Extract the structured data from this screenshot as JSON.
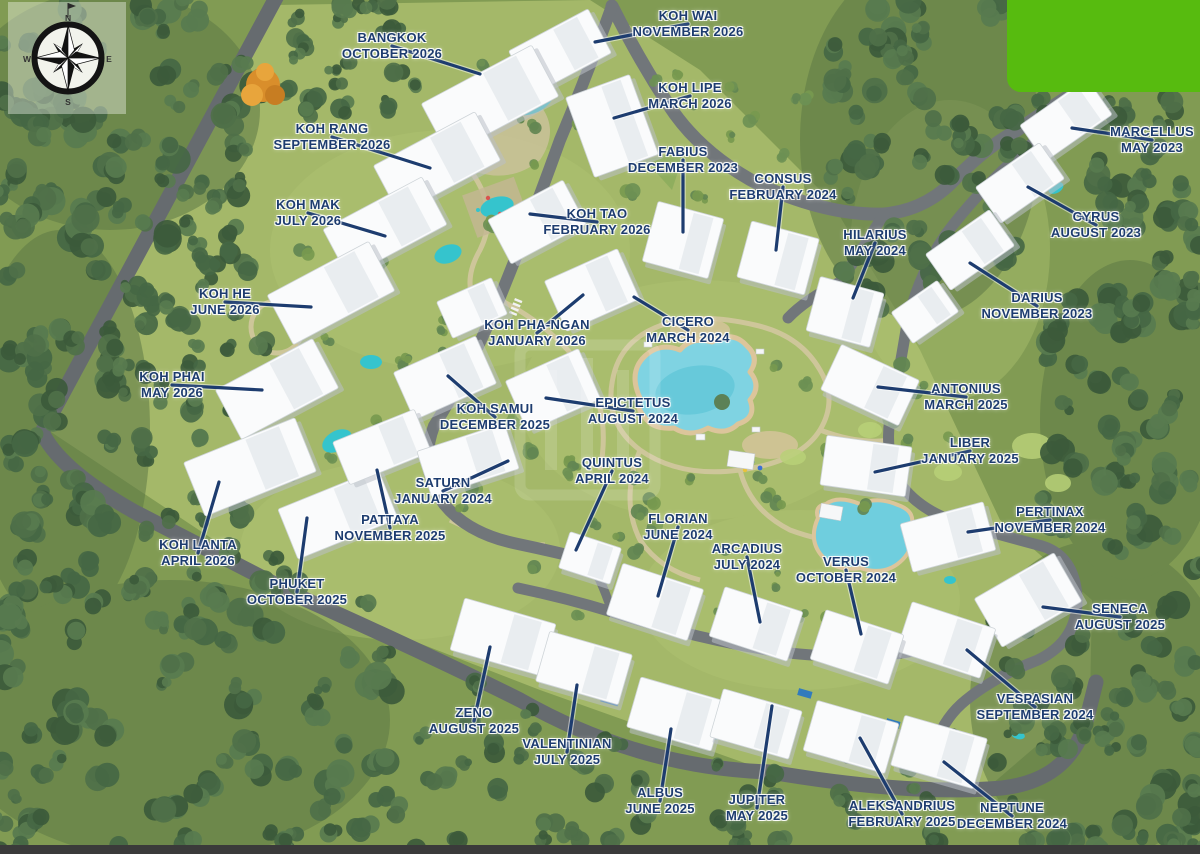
{
  "map": {
    "type": "resort-masterplan-aerial",
    "compass": {
      "north": "N",
      "east": "E",
      "south": "S",
      "west": "W"
    },
    "colors": {
      "label_text": "#1d3c6f",
      "leader_line": "#1d3c6f",
      "highlight_green": "#57bb0f",
      "bottom_bar": "#3a3a3a"
    },
    "buildings": [
      {
        "name": "BANGKOK",
        "date": "OCTOBER 2026",
        "lx": 392,
        "ly": 46,
        "ex": 480,
        "ey": 74
      },
      {
        "name": "KOH WAI",
        "date": "NOVEMBER 2026",
        "lx": 688,
        "ly": 24,
        "ex": 595,
        "ey": 42
      },
      {
        "name": "KOH LIPE",
        "date": "MARCH 2026",
        "lx": 690,
        "ly": 96,
        "ex": 614,
        "ey": 118
      },
      {
        "name": "KOH RANG",
        "date": "SEPTEMBER 2026",
        "lx": 332,
        "ly": 137,
        "ex": 430,
        "ey": 168
      },
      {
        "name": "FABIUS",
        "date": "DECEMBER 2023",
        "lx": 683,
        "ly": 160,
        "ex": 683,
        "ey": 232
      },
      {
        "name": "CONSUS",
        "date": "FEBRUARY 2024",
        "lx": 783,
        "ly": 187,
        "ex": 776,
        "ey": 250
      },
      {
        "name": "MARCELLUS",
        "date": "MAY 2023",
        "lx": 1152,
        "ly": 140,
        "ex": 1072,
        "ey": 128
      },
      {
        "name": "KOH MAK",
        "date": "JULY 2026",
        "lx": 308,
        "ly": 213,
        "ex": 385,
        "ey": 236
      },
      {
        "name": "KOH TAO",
        "date": "FEBRUARY 2026",
        "lx": 597,
        "ly": 222,
        "ex": 530,
        "ey": 214
      },
      {
        "name": "HILARIUS",
        "date": "MAY 2024",
        "lx": 875,
        "ly": 243,
        "ex": 853,
        "ey": 298
      },
      {
        "name": "CYRUS",
        "date": "AUGUST 2023",
        "lx": 1096,
        "ly": 225,
        "ex": 1028,
        "ey": 187
      },
      {
        "name": "KOH HE",
        "date": "JUNE 2026",
        "lx": 225,
        "ly": 302,
        "ex": 311,
        "ey": 307
      },
      {
        "name": "DARIUS",
        "date": "NOVEMBER 2023",
        "lx": 1037,
        "ly": 306,
        "ex": 970,
        "ey": 263
      },
      {
        "name": "KOH PHA-NGAN",
        "date": "JANUARY 2026",
        "lx": 537,
        "ly": 333,
        "ex": 583,
        "ey": 295
      },
      {
        "name": "CICERO",
        "date": "MARCH 2024",
        "lx": 688,
        "ly": 330,
        "ex": 634,
        "ey": 297
      },
      {
        "name": "KOH PHAI",
        "date": "MAY 2026",
        "lx": 172,
        "ly": 385,
        "ex": 262,
        "ey": 390
      },
      {
        "name": "ANTONIUS",
        "date": "MARCH 2025",
        "lx": 966,
        "ly": 397,
        "ex": 878,
        "ey": 387
      },
      {
        "name": "KOH SAMUI",
        "date": "DECEMBER 2025",
        "lx": 495,
        "ly": 417,
        "ex": 448,
        "ey": 376
      },
      {
        "name": "EPICTETUS",
        "date": "AUGUST 2024",
        "lx": 633,
        "ly": 411,
        "ex": 546,
        "ey": 398
      },
      {
        "name": "LIBER",
        "date": "JANUARY 2025",
        "lx": 970,
        "ly": 451,
        "ex": 875,
        "ey": 472
      },
      {
        "name": "QUINTUS",
        "date": "APRIL 2024",
        "lx": 612,
        "ly": 471,
        "ex": 576,
        "ey": 550
      },
      {
        "name": "SATURN",
        "date": "JANUARY 2024",
        "lx": 443,
        "ly": 491,
        "ex": 508,
        "ey": 461
      },
      {
        "name": "PATTAYA",
        "date": "NOVEMBER 2025",
        "lx": 390,
        "ly": 528,
        "ex": 377,
        "ey": 470
      },
      {
        "name": "FLORIAN",
        "date": "JUNE 2024",
        "lx": 678,
        "ly": 527,
        "ex": 658,
        "ey": 596
      },
      {
        "name": "PERTINAX",
        "date": "NOVEMBER 2024",
        "lx": 1050,
        "ly": 520,
        "ex": 968,
        "ey": 532
      },
      {
        "name": "KOH LANTA",
        "date": "APRIL 2026",
        "lx": 198,
        "ly": 553,
        "ex": 219,
        "ey": 482
      },
      {
        "name": "ARCADIUS",
        "date": "JULY 2024",
        "lx": 747,
        "ly": 557,
        "ex": 760,
        "ey": 622
      },
      {
        "name": "VERUS",
        "date": "OCTOBER 2024",
        "lx": 846,
        "ly": 570,
        "ex": 861,
        "ey": 634
      },
      {
        "name": "PHUKET",
        "date": "OCTOBER 2025",
        "lx": 297,
        "ly": 592,
        "ex": 307,
        "ey": 518
      },
      {
        "name": "SENECA",
        "date": "AUGUST 2025",
        "lx": 1120,
        "ly": 617,
        "ex": 1043,
        "ey": 607
      },
      {
        "name": "ZENO",
        "date": "AUGUST 2025",
        "lx": 474,
        "ly": 721,
        "ex": 490,
        "ey": 647
      },
      {
        "name": "VESPASIAN",
        "date": "SEPTEMBER 2024",
        "lx": 1035,
        "ly": 707,
        "ex": 967,
        "ey": 650
      },
      {
        "name": "VALENTINIAN",
        "date": "JULY 2025",
        "lx": 567,
        "ly": 752,
        "ex": 577,
        "ey": 685
      },
      {
        "name": "ALBUS",
        "date": "JUNE 2025",
        "lx": 660,
        "ly": 801,
        "ex": 671,
        "ey": 729
      },
      {
        "name": "JUPITER",
        "date": "MAY 2025",
        "lx": 757,
        "ly": 808,
        "ex": 772,
        "ey": 706
      },
      {
        "name": "ALEKSANDRIUS",
        "date": "FEBRUARY 2025",
        "lx": 902,
        "ly": 814,
        "ex": 860,
        "ey": 738
      },
      {
        "name": "NEPTUNE",
        "date": "DECEMBER 2024",
        "lx": 1012,
        "ly": 816,
        "ex": 944,
        "ey": 762
      }
    ]
  }
}
